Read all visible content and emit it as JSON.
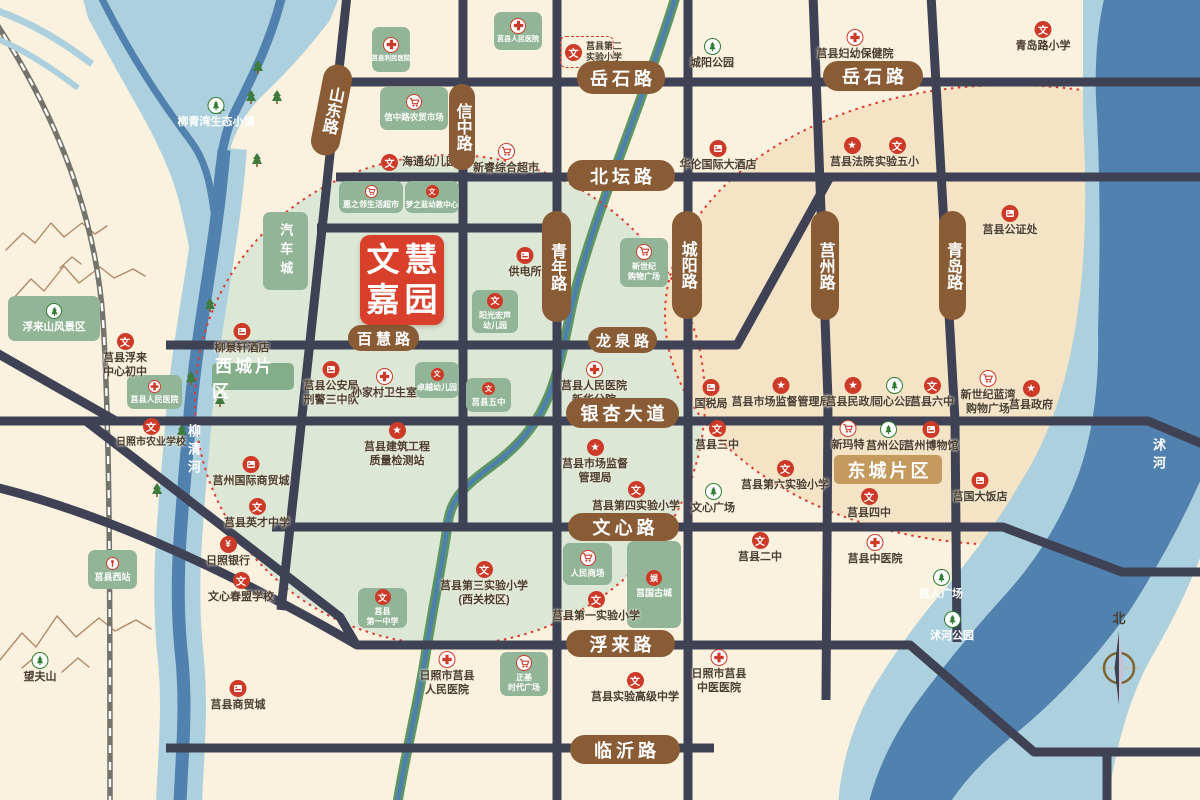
{
  "colors": {
    "bg": "#FAF2DF",
    "road": "#3E4254",
    "road_label_bg": "#8A5C36",
    "zone_west": "#DCE7D6",
    "zone_east": "#F4E3C5",
    "block_green": "#93B597",
    "poi_red": "#CE3A28",
    "river_light": "#ADD0DE",
    "river_dark": "#5181AE",
    "logo_red": "#D8402C",
    "east_label_bg": "#C49A5F",
    "dotted_ring": "#E03A2F"
  },
  "project": {
    "line1": "文慧",
    "line2": "嘉园",
    "x": 360,
    "y": 235,
    "w": 84,
    "h": 90
  },
  "compass": {
    "label": "北",
    "x": 1119,
    "y": 608
  },
  "districts": [
    {
      "label": "西城片区",
      "x": 212,
      "y": 363,
      "w": 82,
      "h": 27,
      "bg": "#84AE89",
      "fs": 17
    },
    {
      "label": "东城片区",
      "x": 834,
      "y": 455,
      "w": 108,
      "h": 29,
      "bg": "#C49A5F",
      "fs": 18
    }
  ],
  "river_labels": [
    {
      "text": "柳清河",
      "x": 184,
      "y": 424
    },
    {
      "text": "沭河",
      "x": 1149,
      "y": 438
    }
  ],
  "road_labels": [
    {
      "text": "山东路",
      "x": 317,
      "y": 64,
      "w": 29,
      "h": 92,
      "v": true,
      "rot": 11
    },
    {
      "text": "信中路",
      "x": 449,
      "y": 84,
      "w": 26,
      "h": 86,
      "v": true
    },
    {
      "text": "岳石路",
      "x": 577,
      "y": 61,
      "w": 88,
      "h": 33
    },
    {
      "text": "岳石路",
      "x": 823,
      "y": 61,
      "w": 100,
      "h": 30
    },
    {
      "text": "北坛路",
      "x": 567,
      "y": 160,
      "w": 108,
      "h": 31
    },
    {
      "text": "青年路",
      "x": 542,
      "y": 211,
      "w": 29,
      "h": 111,
      "v": true
    },
    {
      "text": "城阳路",
      "x": 672,
      "y": 211,
      "w": 30,
      "h": 108,
      "v": true
    },
    {
      "text": "莒州路",
      "x": 811,
      "y": 211,
      "w": 28,
      "h": 109,
      "v": true
    },
    {
      "text": "青岛路",
      "x": 939,
      "y": 211,
      "w": 27,
      "h": 109,
      "v": true
    },
    {
      "text": "百慧路",
      "x": 348,
      "y": 325,
      "w": 71,
      "h": 26,
      "fs": 15
    },
    {
      "text": "龙泉路",
      "x": 588,
      "y": 327,
      "w": 69,
      "h": 26,
      "fs": 15
    },
    {
      "text": "银杏大道",
      "x": 566,
      "y": 398,
      "w": 113,
      "h": 30
    },
    {
      "text": "文心路",
      "x": 568,
      "y": 513,
      "w": 111,
      "h": 28
    },
    {
      "text": "浮来路",
      "x": 566,
      "y": 630,
      "w": 109,
      "h": 27
    },
    {
      "text": "临沂路",
      "x": 570,
      "y": 735,
      "w": 110,
      "h": 29
    }
  ],
  "blocks": [
    {
      "icon": "hospital",
      "lines": [
        "莒县利民医院"
      ],
      "x": 372,
      "y": 27,
      "w": 38,
      "h": 45,
      "fs": 6.5
    },
    {
      "icon": "hospital",
      "lines": [
        "莒县人民医院"
      ],
      "x": 494,
      "y": 12,
      "w": 48,
      "h": 38,
      "fs": 7
    },
    {
      "icon": "market",
      "lines": [
        "信中路农贸市场"
      ],
      "x": 380,
      "y": 87,
      "w": 68,
      "h": 43,
      "fs": 8.5
    },
    {
      "icon": "market",
      "lines": [
        "惠之邻生活超市"
      ],
      "x": 339,
      "y": 181,
      "w": 64,
      "h": 32,
      "fs": 8,
      "small": true
    },
    {
      "icon": "school",
      "lines": [
        "梦之蓝幼教中心"
      ],
      "x": 405,
      "y": 181,
      "w": 54,
      "h": 32,
      "fs": 7.5,
      "small": true
    },
    {
      "lines": [
        "汽车城"
      ],
      "x": 263,
      "y": 212,
      "w": 45,
      "h": 78,
      "fs": 13,
      "vertical": true
    },
    {
      "icon": "market",
      "lines": [
        "新世纪",
        "购物广场"
      ],
      "x": 620,
      "y": 238,
      "w": 48,
      "h": 49,
      "fs": 8
    },
    {
      "icon": "school",
      "lines": [
        "阳光宏声",
        "幼儿园"
      ],
      "x": 472,
      "y": 290,
      "w": 46,
      "h": 43,
      "fs": 8
    },
    {
      "icon": "school",
      "lines": [
        "卓越幼儿园"
      ],
      "x": 415,
      "y": 362,
      "w": 44,
      "h": 36,
      "fs": 8,
      "small": true
    },
    {
      "icon": "school",
      "lines": [
        "莒县五中"
      ],
      "x": 466,
      "y": 378,
      "w": 45,
      "h": 34,
      "fs": 8.5,
      "small": true
    },
    {
      "icon": "market",
      "lines": [
        "人民商场"
      ],
      "x": 563,
      "y": 543,
      "w": 49,
      "h": 42,
      "fs": 8.5
    },
    {
      "icon": "ent",
      "lines": [
        "莒国古城"
      ],
      "x": 627,
      "y": 541,
      "w": 54,
      "h": 87,
      "fs": 9
    },
    {
      "icon": "school",
      "lines": [
        "莒县",
        "第一中学"
      ],
      "x": 358,
      "y": 588,
      "w": 49,
      "h": 40,
      "fs": 8
    },
    {
      "icon": "market",
      "lines": [
        "正基",
        "时代广场"
      ],
      "x": 500,
      "y": 652,
      "w": 48,
      "h": 44,
      "fs": 8
    },
    {
      "icon": "train",
      "lines": [
        "莒县西站"
      ],
      "x": 88,
      "y": 550,
      "w": 49,
      "h": 39,
      "fs": 9,
      "small": true
    },
    {
      "icon": "park",
      "lines": [
        "浮来山风景区"
      ],
      "x": 8,
      "y": 296,
      "w": 92,
      "h": 45,
      "fs": 10.5
    },
    {
      "icon": "hospital",
      "lines": [
        "莒县人民医院"
      ],
      "x": 127,
      "y": 375,
      "w": 55,
      "h": 34,
      "fs": 8,
      "small": true
    }
  ],
  "pois": [
    {
      "type": "school",
      "x": 574,
      "y": 50,
      "lines": [
        "莒县第二",
        "实验小学"
      ],
      "layout": "right",
      "fs": 9,
      "box": [
        560,
        36,
        52,
        30
      ]
    },
    {
      "type": "park",
      "x": 712,
      "y": 47,
      "lines": [
        "城阳公园"
      ]
    },
    {
      "type": "school",
      "x": 1043,
      "y": 30,
      "lines": [
        "青岛路小学"
      ]
    },
    {
      "type": "hospital",
      "x": 855,
      "y": 38,
      "lines": [
        "莒县妇幼保健院"
      ]
    },
    {
      "type": "building",
      "x": 718,
      "y": 149,
      "lines": [
        "华伦国际大酒店"
      ]
    },
    {
      "type": "gov",
      "x": 852,
      "y": 146,
      "lines": [
        "莒县法院"
      ]
    },
    {
      "type": "school",
      "x": 897,
      "y": 146,
      "lines": [
        "实验五小"
      ]
    },
    {
      "type": "building",
      "x": 1010,
      "y": 214,
      "lines": [
        "莒县公证处"
      ]
    },
    {
      "type": "school",
      "x": 390,
      "y": 163,
      "lines": [
        "海通幼儿园"
      ],
      "layout": "right"
    },
    {
      "type": "market",
      "x": 506,
      "y": 152,
      "lines": [
        "新睿综合超市"
      ]
    },
    {
      "type": "building",
      "x": 525,
      "y": 256,
      "lines": [
        "供电所"
      ]
    },
    {
      "type": "park",
      "x": 216,
      "y": 106,
      "lines": [
        "柳青湾生态小镇"
      ],
      "white": true
    },
    {
      "type": "building",
      "x": 242,
      "y": 332,
      "lines": [
        "柳景轩酒店"
      ]
    },
    {
      "type": "school",
      "x": 125,
      "y": 342,
      "lines": [
        "莒县浮来",
        "中心初中"
      ],
      "fs": 11
    },
    {
      "type": "school",
      "x": 151,
      "y": 427,
      "lines": [
        "日照市农业学校"
      ],
      "fs": 10
    },
    {
      "type": "building",
      "x": 251,
      "y": 465,
      "lines": [
        "莒州国际商贸城"
      ]
    },
    {
      "type": "school",
      "x": 257,
      "y": 507,
      "lines": [
        "莒县英才中学"
      ]
    },
    {
      "type": "bank",
      "x": 228,
      "y": 545,
      "lines": [
        "日照银行"
      ]
    },
    {
      "type": "school",
      "x": 241,
      "y": 581,
      "lines": [
        "文心春盟学校"
      ]
    },
    {
      "type": "building",
      "x": 238,
      "y": 689,
      "lines": [
        "莒县商贸城"
      ]
    },
    {
      "type": "park",
      "x": 40,
      "y": 661,
      "lines": [
        "望夫山"
      ]
    },
    {
      "type": "building",
      "x": 331,
      "y": 370,
      "lines": [
        "莒县公安局",
        "刑警三中队"
      ]
    },
    {
      "type": "hospital",
      "x": 370,
      "y": 377,
      "lines": [
        "孙家村卫生室"
      ],
      "tx": 384
    },
    {
      "type": "gov",
      "x": 397,
      "y": 431,
      "lines": [
        "莒县建筑工程",
        "质量检测站"
      ]
    },
    {
      "type": "hospital",
      "x": 594,
      "y": 370,
      "lines": [
        "莒县人民医院",
        "新华分院"
      ]
    },
    {
      "type": "building",
      "x": 711,
      "y": 388,
      "lines": [
        "国税局"
      ]
    },
    {
      "type": "gov",
      "x": 781,
      "y": 386,
      "lines": [
        "莒县市场监督管理局"
      ]
    },
    {
      "type": "gov",
      "x": 853,
      "y": 386,
      "lines": [
        "莒县民政局"
      ]
    },
    {
      "type": "park",
      "x": 894,
      "y": 386,
      "lines": [
        "同心公园"
      ]
    },
    {
      "type": "school",
      "x": 932,
      "y": 386,
      "lines": [
        "莒县六中"
      ]
    },
    {
      "type": "market",
      "x": 988,
      "y": 379,
      "lines": [
        "新世纪蓝湾",
        "购物广场"
      ]
    },
    {
      "type": "gov",
      "x": 1031,
      "y": 389,
      "lines": [
        "莒县政府"
      ]
    },
    {
      "type": "school",
      "x": 717,
      "y": 429,
      "lines": [
        "莒县三中"
      ]
    },
    {
      "type": "market",
      "x": 848,
      "y": 429,
      "lines": [
        "新玛特"
      ]
    },
    {
      "type": "park",
      "x": 888,
      "y": 430,
      "lines": [
        "莒州公园"
      ]
    },
    {
      "type": "building",
      "x": 931,
      "y": 430,
      "lines": [
        "莒州博物馆"
      ]
    },
    {
      "type": "school",
      "x": 785,
      "y": 469,
      "lines": [
        "莒县第六实验小学"
      ]
    },
    {
      "type": "park",
      "x": 713,
      "y": 492,
      "lines": [
        "文心广场"
      ]
    },
    {
      "type": "gov",
      "x": 595,
      "y": 448,
      "lines": [
        "莒县市场监督",
        "管理局"
      ]
    },
    {
      "type": "school",
      "x": 636,
      "y": 490,
      "lines": [
        "莒县第四实验小学"
      ]
    },
    {
      "type": "school",
      "x": 869,
      "y": 497,
      "lines": [
        "莒县四中"
      ]
    },
    {
      "type": "building",
      "x": 980,
      "y": 481,
      "lines": [
        "莒国大饭店"
      ]
    },
    {
      "type": "school",
      "x": 760,
      "y": 541,
      "lines": [
        "莒县二中"
      ]
    },
    {
      "type": "hospital",
      "x": 875,
      "y": 543,
      "lines": [
        "莒县中医院"
      ]
    },
    {
      "type": "school",
      "x": 484,
      "y": 570,
      "lines": [
        "莒县第三实验小学",
        "(西关校区)"
      ]
    },
    {
      "type": "school",
      "x": 596,
      "y": 600,
      "lines": [
        "莒县第一实验小学"
      ]
    },
    {
      "type": "park",
      "x": 941,
      "y": 578,
      "lines": [
        "莒人广场"
      ],
      "white": true
    },
    {
      "type": "park",
      "x": 952,
      "y": 620,
      "lines": [
        "沭河公园"
      ],
      "white": true
    },
    {
      "type": "hospital",
      "x": 447,
      "y": 660,
      "lines": [
        "日照市莒县",
        "人民医院"
      ]
    },
    {
      "type": "school",
      "x": 635,
      "y": 681,
      "lines": [
        "莒县实验高级中学"
      ]
    },
    {
      "type": "hospital",
      "x": 719,
      "y": 658,
      "lines": [
        "日照市莒县",
        "中医医院"
      ]
    }
  ]
}
